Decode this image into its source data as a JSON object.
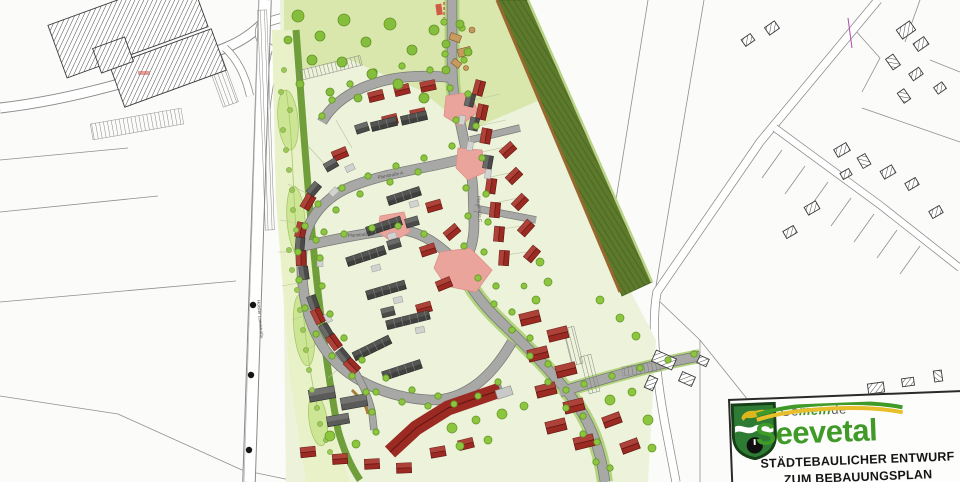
{
  "logo": {
    "gemeinde_pre": "Ge",
    "gemeinde_accent": "mein",
    "gemeinde_post": "de",
    "municipality": "Seevetal",
    "title_line1": "STÄDTEBAULICHER ENTWURF",
    "title_line2": "ZUM BEBAUUNGSPLAN"
  },
  "street_labels": [
    {
      "text": "Horster Landstraße",
      "x": 257,
      "y": 300,
      "rot": 85
    },
    {
      "text": "Planstraße A",
      "x": 378,
      "y": 179,
      "rot": -11
    },
    {
      "text": "Planstraße B",
      "x": 348,
      "y": 237,
      "rot": -4
    },
    {
      "text": "Planstraße C",
      "x": 477,
      "y": 196,
      "rot": 86
    }
  ],
  "colors": {
    "paper": "#fbfbf9",
    "cadastralLine": "#8f8f8d",
    "siteLawn": "#edf2da",
    "parkGreen": "#d9e7ad",
    "swaleLight": "#e9f1c9",
    "swaleBlob": "#cde696",
    "greenBand": "#6f9e3b",
    "embankment": "#5d7a2c",
    "embankBrown": "#96682e",
    "roadGray": "#a8a8a6",
    "roadEdge": "#787876",
    "treeGreen": "#8cc63e",
    "treeStroke": "#639427",
    "roofRed": "#9b2a23",
    "roofRedLight": "#c05a50",
    "roofRedDark": "#5f1410",
    "roofGray": "#4a4a49",
    "roofGrayLight": "#8a8a88",
    "carport": "#d2d2d0",
    "plaza": "#eba49c",
    "logoGreen": "#3f9a28",
    "shieldGreen": "#2e7c33",
    "crestYellow": "#ddb61f",
    "swooshYellow": "#e8bf2a"
  },
  "map": {
    "houses_red": [
      [
        376,
        96,
        -14
      ],
      [
        402,
        90,
        -14
      ],
      [
        428,
        86,
        -12
      ],
      [
        390,
        120,
        -14
      ],
      [
        418,
        114,
        -12
      ],
      [
        340,
        154,
        -22
      ],
      [
        308,
        202,
        -60
      ],
      [
        301,
        230,
        -78
      ],
      [
        301,
        258,
        -92
      ],
      [
        318,
        316,
        -116
      ],
      [
        334,
        342,
        -126
      ],
      [
        352,
        366,
        -134
      ],
      [
        434,
        206,
        -16
      ],
      [
        452,
        232,
        -40
      ],
      [
        428,
        250,
        -18
      ],
      [
        444,
        284,
        -22
      ],
      [
        424,
        308,
        -16
      ],
      [
        308,
        452,
        -6
      ],
      [
        340,
        459,
        -4
      ],
      [
        372,
        464,
        -3
      ],
      [
        404,
        468,
        -2
      ],
      [
        438,
        452,
        -10
      ],
      [
        466,
        444,
        -14
      ],
      [
        479,
        88,
        -75
      ],
      [
        482,
        112,
        -78
      ],
      [
        486,
        136,
        -80
      ],
      [
        491,
        186,
        -82
      ],
      [
        495,
        210,
        -84
      ],
      [
        499,
        234,
        -85
      ],
      [
        504,
        258,
        -86
      ],
      [
        508,
        150,
        -42
      ],
      [
        514,
        176,
        -44
      ],
      [
        520,
        202,
        -46
      ],
      [
        526,
        228,
        -48
      ],
      [
        532,
        254,
        -50
      ]
    ],
    "houses_gray": [
      [
        331,
        165,
        -30
      ],
      [
        314,
        189,
        -50
      ],
      [
        300,
        244,
        -85
      ],
      [
        304,
        273,
        -98
      ],
      [
        313,
        302,
        -110
      ],
      [
        326,
        330,
        -121
      ],
      [
        343,
        355,
        -130
      ],
      [
        362,
        128,
        -18
      ],
      [
        412,
        222,
        -16
      ],
      [
        394,
        244,
        -16
      ],
      [
        388,
        312,
        -14
      ],
      [
        470,
        100,
        -76
      ],
      [
        474,
        124,
        -78
      ],
      [
        488,
        162,
        -80
      ]
    ],
    "rowhouses": [
      [
        404,
        196,
        34,
        -18
      ],
      [
        384,
        226,
        36,
        -18
      ],
      [
        366,
        256,
        40,
        -18
      ],
      [
        386,
        290,
        40,
        -16
      ],
      [
        408,
        320,
        44,
        -14
      ],
      [
        384,
        124,
        26,
        -14
      ],
      [
        414,
        118,
        26,
        -13
      ],
      [
        372,
        348,
        40,
        -26
      ],
      [
        402,
        370,
        40,
        -18
      ]
    ],
    "multifam_red": [
      [
        530,
        318,
        20,
        12,
        -14
      ],
      [
        558,
        334,
        20,
        12,
        -14
      ],
      [
        538,
        354,
        20,
        12,
        -14
      ],
      [
        566,
        370,
        20,
        12,
        -14
      ],
      [
        546,
        390,
        20,
        12,
        -14
      ],
      [
        574,
        406,
        20,
        12,
        -14
      ],
      [
        556,
        426,
        20,
        12,
        -14
      ],
      [
        584,
        442,
        20,
        12,
        -14
      ],
      [
        612,
        420,
        18,
        11,
        -20
      ],
      [
        630,
        446,
        18,
        11,
        -20
      ]
    ],
    "multifam_gray": [
      [
        322,
        394,
        26,
        12,
        -10
      ],
      [
        354,
        402,
        26,
        12,
        -10
      ],
      [
        338,
        420,
        22,
        10,
        -10
      ]
    ],
    "carports": [
      [
        414,
        204,
        -16
      ],
      [
        392,
        236,
        -16
      ],
      [
        376,
        268,
        -16
      ],
      [
        398,
        300,
        -14
      ],
      [
        420,
        330,
        -12
      ],
      [
        350,
        168,
        -25
      ],
      [
        334,
        192,
        -45
      ],
      [
        320,
        262,
        -90
      ],
      [
        328,
        318,
        -115
      ],
      [
        462,
        120,
        -78
      ],
      [
        470,
        146,
        -80
      ],
      [
        488,
        174,
        -82
      ]
    ],
    "existing_buildings": [
      [
        128,
        26,
        150,
        56,
        -20
      ],
      [
        168,
        68,
        108,
        44,
        -20
      ],
      [
        113,
        55,
        34,
        26,
        -20
      ],
      [
        906,
        30,
        16,
        11,
        -35
      ],
      [
        921,
        44,
        13,
        9,
        -35
      ],
      [
        893,
        62,
        13,
        9,
        55
      ],
      [
        916,
        74,
        12,
        8,
        -35
      ],
      [
        904,
        96,
        12,
        8,
        55
      ],
      [
        940,
        88,
        10,
        8,
        -35
      ],
      [
        842,
        150,
        14,
        9,
        -30
      ],
      [
        864,
        161,
        12,
        9,
        60
      ],
      [
        888,
        172,
        13,
        9,
        -30
      ],
      [
        912,
        184,
        12,
        8,
        -30
      ],
      [
        846,
        174,
        10,
        7,
        -30
      ],
      [
        812,
        208,
        13,
        9,
        -30
      ],
      [
        790,
        232,
        12,
        8,
        -30
      ],
      [
        936,
        212,
        12,
        8,
        -30
      ],
      [
        876,
        388,
        16,
        10,
        -8
      ],
      [
        908,
        382,
        12,
        8,
        -8
      ],
      [
        938,
        376,
        11,
        8,
        82
      ],
      [
        664,
        360,
        22,
        12,
        24
      ],
      [
        687,
        379,
        14,
        10,
        24
      ],
      [
        703,
        361,
        10,
        8,
        24
      ],
      [
        651,
        383,
        9,
        13,
        24
      ],
      [
        772,
        28,
        12,
        9,
        -35
      ],
      [
        748,
        40,
        11,
        8,
        -35
      ]
    ],
    "plazas": [
      "M446,96 L470,92 L478,112 L460,126 L444,116 Z",
      "M458,148 L482,150 L486,172 L468,180 L456,168 Z",
      "M380,216 L404,212 L410,232 L392,242 L378,232 Z",
      "M440,252 L470,248 L492,270 L476,292 L446,286 L434,268 Z"
    ],
    "combs": [
      [
        137,
        124,
        92,
        16,
        -10
      ],
      [
        222,
        80,
        16,
        52,
        -20
      ],
      [
        266,
        120,
        9,
        220,
        -2
      ],
      [
        330,
        68,
        64,
        10,
        -14
      ],
      [
        573,
        346,
        11,
        38,
        -14
      ],
      [
        590,
        374,
        11,
        38,
        -14
      ],
      [
        641,
        369,
        38,
        9,
        -8
      ]
    ],
    "dots": [
      [
        253,
        305
      ],
      [
        251,
        375
      ],
      [
        249,
        450
      ]
    ],
    "trees_street": [
      [
        444,
        22
      ],
      [
        462,
        28
      ],
      [
        445,
        54
      ],
      [
        464,
        60
      ],
      [
        450,
        88
      ],
      [
        468,
        94
      ],
      [
        456,
        120
      ],
      [
        476,
        126
      ],
      [
        482,
        158
      ],
      [
        466,
        188
      ],
      [
        486,
        194
      ],
      [
        468,
        216
      ],
      [
        488,
        222
      ],
      [
        464,
        246
      ],
      [
        484,
        252
      ],
      [
        478,
        278
      ],
      [
        496,
        286
      ],
      [
        494,
        304
      ],
      [
        512,
        312
      ],
      [
        512,
        330
      ],
      [
        530,
        338
      ],
      [
        530,
        356
      ],
      [
        548,
        364
      ],
      [
        548,
        382
      ],
      [
        566,
        390
      ],
      [
        566,
        408
      ],
      [
        583,
        416
      ],
      [
        583,
        434
      ],
      [
        597,
        442
      ],
      [
        596,
        462
      ],
      [
        610,
        468
      ],
      [
        452,
        146
      ],
      [
        424,
        158
      ],
      [
        396,
        166
      ],
      [
        368,
        176
      ],
      [
        342,
        188
      ],
      [
        318,
        204
      ],
      [
        305,
        226
      ],
      [
        298,
        252
      ],
      [
        299,
        280
      ],
      [
        305,
        308
      ],
      [
        316,
        334
      ],
      [
        332,
        356
      ],
      [
        352,
        376
      ],
      [
        376,
        392
      ],
      [
        402,
        402
      ],
      [
        428,
        406
      ],
      [
        454,
        404
      ],
      [
        478,
        396
      ],
      [
        498,
        382
      ],
      [
        430,
        70
      ],
      [
        402,
        66
      ],
      [
        374,
        72
      ],
      [
        350,
        84
      ],
      [
        332,
        100
      ],
      [
        322,
        116
      ],
      [
        316,
        240
      ],
      [
        344,
        234
      ],
      [
        372,
        228
      ],
      [
        398,
        226
      ],
      [
        424,
        234
      ],
      [
        584,
        384
      ],
      [
        612,
        376
      ],
      [
        640,
        368
      ],
      [
        668,
        360
      ],
      [
        694,
        354
      ],
      [
        366,
        392
      ],
      [
        372,
        412
      ],
      [
        376,
        432
      ],
      [
        418,
        172
      ],
      [
        390,
        182
      ],
      [
        360,
        194
      ],
      [
        336,
        210
      ],
      [
        324,
        232
      ],
      [
        320,
        258
      ],
      [
        322,
        286
      ],
      [
        330,
        314
      ],
      [
        344,
        338
      ],
      [
        362,
        360
      ],
      [
        386,
        378
      ],
      [
        412,
        390
      ],
      [
        438,
        396
      ]
    ],
    "trees_park": [
      [
        298,
        16,
        6
      ],
      [
        320,
        36,
        5
      ],
      [
        344,
        20,
        6
      ],
      [
        366,
        42,
        5
      ],
      [
        390,
        24,
        6
      ],
      [
        412,
        50,
        5
      ],
      [
        434,
        30,
        5
      ],
      [
        342,
        62,
        5
      ],
      [
        312,
        60,
        5
      ],
      [
        372,
        74,
        5
      ],
      [
        398,
        84,
        5
      ],
      [
        424,
        98,
        5
      ],
      [
        288,
        40,
        4
      ],
      [
        446,
        44,
        4
      ],
      [
        300,
        84,
        4
      ],
      [
        330,
        92,
        4
      ],
      [
        358,
        98,
        4
      ],
      [
        446,
        70,
        4
      ],
      [
        460,
        24,
        4
      ],
      [
        468,
        52,
        4
      ]
    ],
    "trees_swale": [
      [
        284,
        70
      ],
      [
        290,
        110
      ],
      [
        286,
        150
      ],
      [
        292,
        190
      ],
      [
        296,
        230
      ],
      [
        292,
        270
      ],
      [
        300,
        310
      ],
      [
        306,
        350
      ],
      [
        312,
        390
      ],
      [
        320,
        424
      ],
      [
        330,
        452
      ],
      [
        281,
        92
      ],
      [
        283,
        130
      ],
      [
        289,
        170
      ],
      [
        293,
        210
      ],
      [
        289,
        250
      ],
      [
        297,
        290
      ],
      [
        303,
        330
      ],
      [
        309,
        370
      ],
      [
        317,
        408
      ],
      [
        326,
        440
      ]
    ],
    "trees_lawn": [
      [
        330,
        436,
        5
      ],
      [
        356,
        444,
        4
      ],
      [
        452,
        428,
        5
      ],
      [
        476,
        420,
        4
      ],
      [
        502,
        414,
        5
      ],
      [
        524,
        406,
        4
      ],
      [
        610,
        400,
        5
      ],
      [
        632,
        392,
        4
      ],
      [
        648,
        420,
        5
      ],
      [
        652,
        448,
        4
      ],
      [
        460,
        446,
        4
      ],
      [
        488,
        440,
        4
      ],
      [
        536,
        300,
        4
      ],
      [
        548,
        282,
        4
      ],
      [
        540,
        262,
        4
      ],
      [
        524,
        286,
        3
      ],
      [
        600,
        300,
        4
      ],
      [
        620,
        318,
        4
      ],
      [
        636,
        336,
        4
      ]
    ]
  }
}
